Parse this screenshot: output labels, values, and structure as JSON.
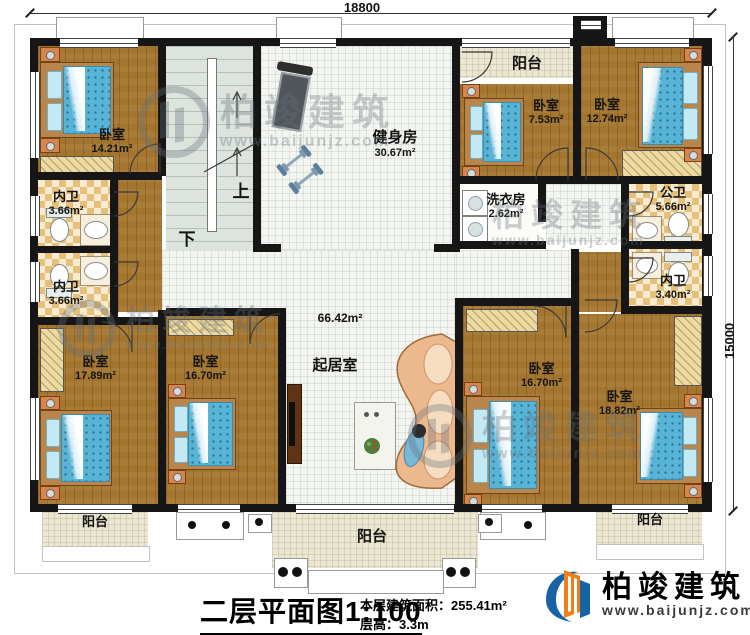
{
  "plan": {
    "dimensions": {
      "top": "18800",
      "right": "15000"
    },
    "stairs": {
      "up": "上",
      "down": "下"
    },
    "rooms": {
      "bedroom_tl": {
        "label": "卧室",
        "area": "14.21m²"
      },
      "bath_l1": {
        "label": "内卫",
        "area": "3.66m²"
      },
      "bath_l2": {
        "label": "内卫",
        "area": "3.66m²"
      },
      "gym": {
        "label": "健身房",
        "area": "30.67m²"
      },
      "balcony_top": {
        "label": "阳台"
      },
      "bedroom_tm": {
        "label": "卧室",
        "area": "7.53m²"
      },
      "bedroom_tr": {
        "label": "卧室",
        "area": "12.74m²"
      },
      "laundry": {
        "label": "洗衣房",
        "area": "2.62m²"
      },
      "bath_r1": {
        "label": "公卫",
        "area": "5.66m²"
      },
      "bath_r2": {
        "label": "内卫",
        "area": "3.40m²"
      },
      "living": {
        "label": "起居室",
        "area": "66.42m²"
      },
      "bedroom_bl": {
        "label": "卧室",
        "area": "17.89m²"
      },
      "bedroom_bm": {
        "label": "卧室",
        "area": "16.70m²"
      },
      "bedroom_br1": {
        "label": "卧室",
        "area": "16.70m²"
      },
      "bedroom_br2": {
        "label": "卧室",
        "area": "18.82m²"
      },
      "balcony_bl": {
        "label": "阳台"
      },
      "balcony_bc": {
        "label": "阳台"
      },
      "balcony_br": {
        "label": "阳台"
      }
    }
  },
  "titleblock": {
    "title": "二层平面图",
    "scale": "1:100",
    "area_label": "本层建筑面积：",
    "area_value": "255.41m²",
    "height_label": "层高：",
    "height_value": "3.3m"
  },
  "brand": {
    "name": "柏竣建筑",
    "website": "www.baijunjz.com"
  },
  "watermark": {
    "name": "柏竣建筑",
    "website": "www.baijunjz.com"
  },
  "colors": {
    "wall": "#161616",
    "wood": "#a3752e",
    "tile": "#f3f5f1",
    "checker": "#e6bf7b",
    "balcony": "#ece7d3",
    "bed_blue": "#58b4d6",
    "logo_blue": "#1763a6",
    "logo_orange": "#ef7f1a"
  }
}
